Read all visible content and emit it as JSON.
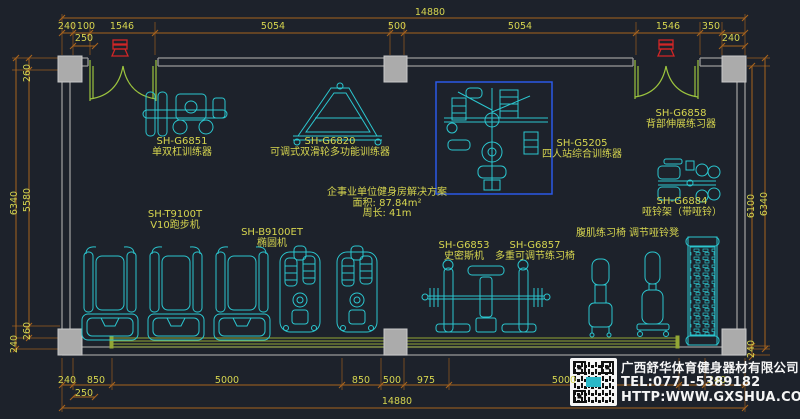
{
  "colors": {
    "background": "#1d222b",
    "dimension_line": "#a8641e",
    "dimension_text": "#d6d54f",
    "equipment_line": "#2bc6cf",
    "wall": "#9a9a9a",
    "door": "#9cc43e",
    "floor_strip": "#93a735",
    "highlight_box": "#2b59e8",
    "door_marker": "#d22626",
    "company_text": "#f5f5f5"
  },
  "dimension_labels": [
    {
      "text": "14880",
      "x": 430,
      "y": 13
    },
    {
      "text": "240",
      "x": 67,
      "y": 27
    },
    {
      "text": "100",
      "x": 86,
      "y": 27
    },
    {
      "text": "1546",
      "x": 122,
      "y": 27
    },
    {
      "text": "5054",
      "x": 273,
      "y": 27
    },
    {
      "text": "500",
      "x": 397,
      "y": 27
    },
    {
      "text": "5054",
      "x": 520,
      "y": 27
    },
    {
      "text": "1546",
      "x": 668,
      "y": 27
    },
    {
      "text": "350",
      "x": 711,
      "y": 27
    },
    {
      "text": "250",
      "x": 84,
      "y": 39
    },
    {
      "text": "240",
      "x": 731,
      "y": 39
    },
    {
      "text": "6340",
      "x": 15,
      "y": 203,
      "rot": 1
    },
    {
      "text": "260",
      "x": 28,
      "y": 73,
      "rot": 1
    },
    {
      "text": "5580",
      "x": 28,
      "y": 200,
      "rot": 1
    },
    {
      "text": "260",
      "x": 28,
      "y": 331,
      "rot": 1
    },
    {
      "text": "240",
      "x": 15,
      "y": 344,
      "rot": 1
    },
    {
      "text": "6100",
      "x": 752,
      "y": 206,
      "rot": 1
    },
    {
      "text": "6340",
      "x": 765,
      "y": 204,
      "rot": 1
    },
    {
      "text": "240",
      "x": 752,
      "y": 349,
      "rot": 1
    },
    {
      "text": "240",
      "x": 67,
      "y": 381
    },
    {
      "text": "850",
      "x": 96,
      "y": 381
    },
    {
      "text": "5000",
      "x": 227,
      "y": 381
    },
    {
      "text": "850",
      "x": 361,
      "y": 381
    },
    {
      "text": "500",
      "x": 392,
      "y": 381
    },
    {
      "text": "975",
      "x": 426,
      "y": 381
    },
    {
      "text": "5000",
      "x": 564,
      "y": 381
    },
    {
      "text": "240",
      "x": 717,
      "y": 381
    },
    {
      "text": "250",
      "x": 84,
      "y": 394
    },
    {
      "text": "14880",
      "x": 397,
      "y": 402
    }
  ],
  "equipment": [
    {
      "model": "SH-G6851",
      "name": "单双杠训练器",
      "x": 182,
      "y": 136
    },
    {
      "model": "SH-G6820",
      "name": "可调式双滑轮多功能训练器",
      "x": 330,
      "y": 136
    },
    {
      "model": "SH-G5205",
      "name": "四人站综合训练器",
      "x": 582,
      "y": 138
    },
    {
      "model": "SH-G6858",
      "name": "背部伸展练习器",
      "x": 681,
      "y": 108
    },
    {
      "model": "SH-G6884",
      "name": "哑铃架（带哑铃）",
      "x": 682,
      "y": 196
    },
    {
      "model": "",
      "name": "调节哑铃凳",
      "x": 654,
      "y": 228
    },
    {
      "model": "",
      "name": "腹肌练习椅",
      "x": 601,
      "y": 228
    },
    {
      "model": "SH-T9100T",
      "name": "V10跑步机",
      "x": 175,
      "y": 209
    },
    {
      "model": "SH-B9100ET",
      "name": "椭圆机",
      "x": 272,
      "y": 227
    },
    {
      "model": "SH-G6853",
      "name": "史密斯机",
      "x": 464,
      "y": 240
    },
    {
      "model": "SH-G6857",
      "name": "多重可调节练习椅",
      "x": 535,
      "y": 240
    }
  ],
  "solution": {
    "title": "企事业单位健身房解决方案",
    "area": "面积: 87.84m²",
    "perimeter": "周长: 41m"
  },
  "company": {
    "name": "广西舒华体育健身器材有限公司",
    "tel": "TEL:0771-5389182",
    "website": "HTTP:WWW.GXSHUA.COM"
  }
}
